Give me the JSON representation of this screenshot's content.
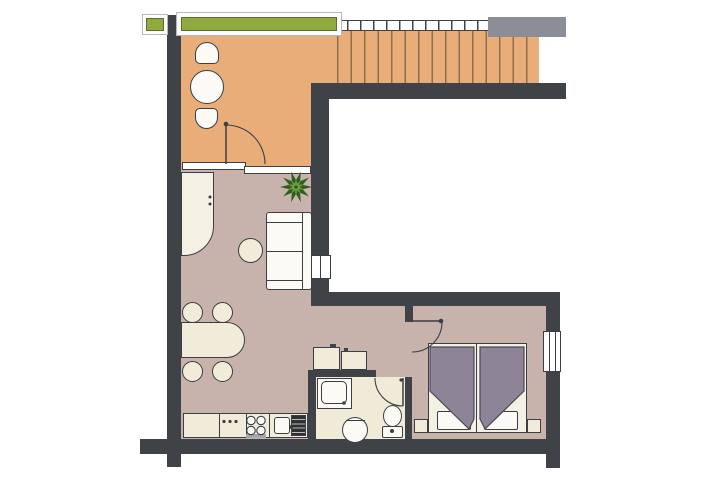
{
  "scene": {
    "type": "apartment floor plan drawing",
    "text_visible": "none"
  },
  "colors": {
    "wall": "#3f4246",
    "outline": "#3b3e42",
    "tread": "#e9ad79",
    "treadline": "#8f6e4e",
    "living": "#c8b2ac",
    "bath": "#f0ead8",
    "handrail": "#8b8e97",
    "green": "#8fa93e",
    "cream": "#f0ecd9",
    "white": "#fbfaf4",
    "bedframe": "#f3f0e4",
    "duvet": "#8d8498",
    "duvetedge": "#4c4754",
    "plantdark": "#2f5c1f",
    "plantlight": "#6aa33d",
    "framegray": "#b6b8bb",
    "drainer": "#2e3032"
  },
  "rooms": {
    "balcony": {
      "label": "balcony / terrace"
    },
    "stairs": {
      "label": "staircase"
    },
    "landing": {
      "label": "stair landing"
    },
    "living": {
      "label": "living room"
    },
    "corridor": {
      "label": "hallway and bedroom area"
    },
    "bathroom": {
      "label": "bathroom"
    },
    "void": {
      "label": "open void"
    }
  },
  "furniture": {
    "planter_small": "small planter box",
    "planter_long": "long planter box",
    "balcony_table": "round bistro table",
    "balcony_chair_top": "balcony chair",
    "balcony_chair_bottom": "balcony chair",
    "wardrobe": "wardrobe with rounded corner",
    "plant": "potted plant",
    "sofa": "two-seat sofa",
    "coffee_table": "round coffee table",
    "dining_table": "dining table",
    "dining_chair": "dining chair",
    "counter": "kitchen counter",
    "knobs": "control knobs",
    "cooktop": "4-burner cooktop",
    "oven_handle": "oven handle",
    "sink": "kitchen sink",
    "drainer": "sink drainer",
    "cabinet_left": "storage cabinet",
    "cabinet_right": "storage cabinet",
    "shower": "shower tray",
    "basin": "pedestal washbasin",
    "toilet": "toilet",
    "bed_left": "single bed with duvet",
    "bed_right": "single bed with duvet",
    "pillow": "pillow",
    "nightstand": "nightstand"
  },
  "openings": {
    "sliding_door": "sliding glass door",
    "balcony_door": "balcony swing door",
    "bathroom_door": "bathroom swing door",
    "bedroom_door": "bedroom swing door",
    "living_window": "internal window",
    "bedroom_window": "bedroom window"
  }
}
